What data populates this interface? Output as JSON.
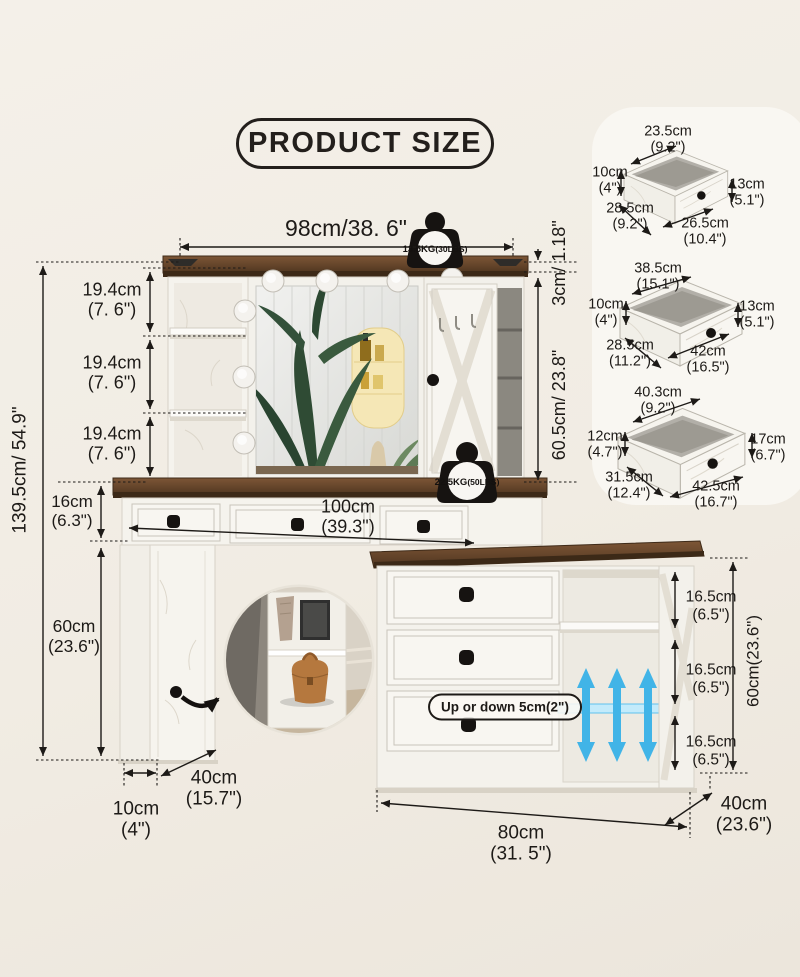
{
  "title": "PRODUCT SIZE",
  "colors": {
    "ink": "#1d1a17",
    "wood": "#6b4a2d",
    "accent_blue": "#41b4e7",
    "background": "#f1ece3",
    "furniture_white": "#f5f3ed"
  },
  "badges": {
    "top": {
      "kg": "13.5KG",
      "lbs": "(30LBS)"
    },
    "front": {
      "kg": "22.5KG",
      "lbs": "(50LBS)"
    }
  },
  "main": {
    "width_top": "98cm/38. 6\"",
    "top_thickness_rot": "3cm/ 1.18\"",
    "hutch_height_rot": "60.5cm/ 23.8\"",
    "total_height_rot": "139.5cm/ 54.9\"",
    "cabinet_height_rot": "60cm(23.6\")",
    "sections": [
      {
        "cm": "19.4cm",
        "in": "(7. 6\")"
      },
      {
        "cm": "19.4cm",
        "in": "(7. 6\")"
      },
      {
        "cm": "19.4cm",
        "in": "(7. 6\")"
      }
    ],
    "desk_height": {
      "cm": "16cm",
      "in": "(6.3\")"
    },
    "desk_width": {
      "cm": "100cm",
      "in": "(39.3\")"
    },
    "pedestal_height": {
      "cm": "60cm",
      "in": "(23.6\")"
    },
    "pedestal_width": {
      "cm": "10cm",
      "in": "(4\")"
    },
    "pedestal_depth": {
      "cm": "40cm",
      "in": "(15.7\")"
    },
    "cabinet_width": {
      "cm": "80cm",
      "in": "(31. 5\")"
    },
    "cabinet_depth": {
      "cm": "40cm",
      "in": "(23.6\")"
    },
    "shelf_gaps": [
      {
        "cm": "16.5cm",
        "in": "(6.5\")"
      },
      {
        "cm": "16.5cm",
        "in": "(6.5\")"
      },
      {
        "cm": "16.5cm",
        "in": "(6.5\")"
      }
    ],
    "adjustable_note": "Up or down 5cm(2\")"
  },
  "drawers": [
    {
      "w_top": {
        "cm": "23.5cm",
        "in": "(9.2\")"
      },
      "h_left": {
        "cm": "10cm",
        "in": "(4\")"
      },
      "d_left": {
        "cm": "28.5cm",
        "in": "(9.2\")"
      },
      "w_bottom": {
        "cm": "26.5cm",
        "in": "(10.4\")"
      },
      "h_right": {
        "cm": "13cm",
        "in": "(5.1\")"
      }
    },
    {
      "w_top": {
        "cm": "38.5cm",
        "in": "(15.1\")"
      },
      "h_left": {
        "cm": "10cm",
        "in": "(4\")"
      },
      "d_left": {
        "cm": "28.5cm",
        "in": "(11.2\")"
      },
      "w_bottom": {
        "cm": "42cm",
        "in": "(16.5\")"
      },
      "h_right": {
        "cm": "13cm",
        "in": "(5.1\")"
      }
    },
    {
      "w_top": {
        "cm": "40.3cm",
        "in": "(9.2\")"
      },
      "h_left": {
        "cm": "12cm",
        "in": "(4.7\")"
      },
      "d_left": {
        "cm": "31.5cm",
        "in": "(12.4\")"
      },
      "w_bottom": {
        "cm": "42.5cm",
        "in": "(16.7\")"
      },
      "h_right": {
        "cm": "17cm",
        "in": "(6.7\")"
      }
    }
  ]
}
